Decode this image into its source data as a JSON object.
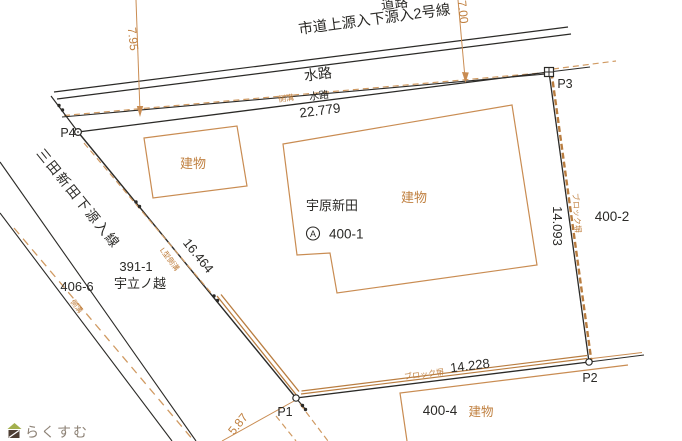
{
  "colors": {
    "line_black": "#2b2a27",
    "line_orange": "#c98c52",
    "dash_orange": "#d09a62",
    "wall_orange": "#b97d40",
    "text_black": "#2b2a27",
    "text_orange": "#c08040",
    "logo_text": "#8d8276",
    "logo_green": "#a3b04e",
    "logo_brown": "#4d3e33"
  },
  "north": {
    "road_label": "道路",
    "road_name": "市道上源入下源入2号線",
    "water_label_large": "水路",
    "gutter_label": "側溝",
    "water_label_small": "水路",
    "dim_boundary": "22.779",
    "dim_arrow_left": "7.95",
    "dim_arrow_right": "7.00"
  },
  "points": {
    "p1": "P1",
    "p2": "P2",
    "p3": "P3",
    "p4": "P4"
  },
  "east": {
    "dim": "14.093",
    "wall": "ブロック塀",
    "parcel": "400-2"
  },
  "south": {
    "dim": "14.228",
    "wall": "ブロック塀",
    "parcel": "400-4",
    "building_label": "建物"
  },
  "west": {
    "dim": "16.464",
    "gutter_label": "L型側溝",
    "road_name": "三田新田下源入線",
    "parcel1_no": "391-1",
    "parcel1_name": "宇立ノ越",
    "parcel2_no": "406-6",
    "dim_sw": "5.87",
    "gutter_label2": "側溝"
  },
  "main_parcel": {
    "name": "宇原新田",
    "mark": "A",
    "number": "400-1",
    "building_label": "建物",
    "building_nw_label": "建物"
  },
  "logo": {
    "text": "らくすむ"
  }
}
